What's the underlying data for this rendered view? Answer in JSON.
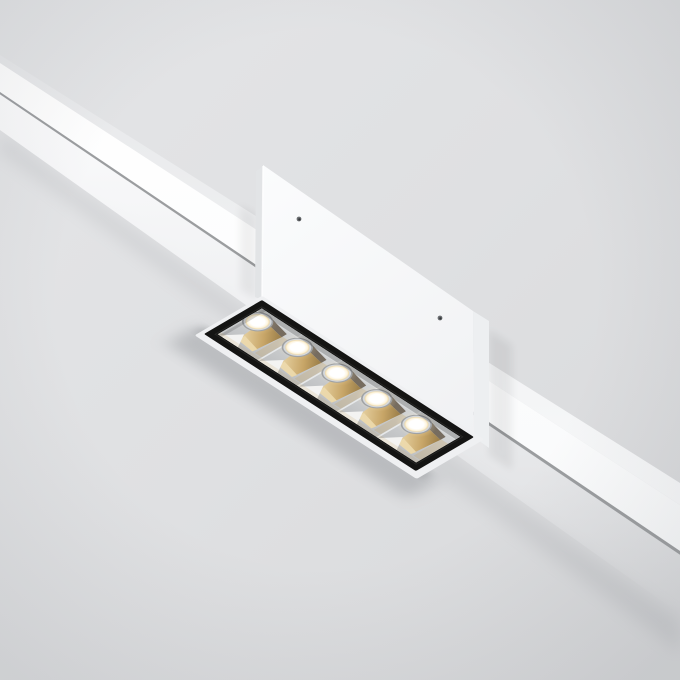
{
  "meta": {
    "description": "Product photo of a white linear magnetic-track ceiling spotlight with five warm-gold LED reflector cells, mounted on a white track rail crossing a light gray ceiling diagonally"
  },
  "colors": {
    "bg_base": "#dfe0e2",
    "vignette_tint": "#75797f",
    "rail_lip_light": "#f8f9fa",
    "rail_lip_dark": "#e7e8ea",
    "rail_face_white": "#ffffff",
    "rail_face_soft": "#f2f3f5",
    "rail_edge_line": "#8e9193",
    "rail_glow_top": "#fdfdfe",
    "box_face_light": "#fbfcfd",
    "box_face_dark": "#f0f1f3",
    "box_end_face": "#edeff1",
    "box_side_sliver": "#e2e4e6",
    "panel_flange": "#eff0f2",
    "panel_black": "#141413",
    "panel_bevel": "#2c2c2a",
    "cell_base_light": "#d6d8d9",
    "cell_base_dark": "#bdbfc1",
    "cell_top_sliver": "#d9dbdd",
    "cell_divider": "#e8eaeb",
    "gold_light": "#ecd9ac",
    "gold_mid": "#c7a567",
    "gold_dark": "#8e7340",
    "bronze_wedge": "#6b6052",
    "white_wedge": "#f3f3f2",
    "lens_ring_dark": "#9fa2a5",
    "lens_ring_light": "#d6d8da",
    "lens_core": "#ffffff",
    "lens_warm_edge": "#ecd5a2",
    "glow_warm": "#ffe9bd",
    "screw_mid": "#6a6d70",
    "screw_dark": "#35373a",
    "shadow_tint": "#85888d"
  },
  "panel": {
    "cell_count": 5,
    "cells": [
      {
        "glow_opacity": 0.35
      },
      {
        "glow_opacity": 0.45
      },
      {
        "glow_opacity": 0.55
      },
      {
        "glow_opacity": 0.7
      },
      {
        "glow_opacity": 0.75
      }
    ]
  },
  "screws": {
    "count": 2
  }
}
